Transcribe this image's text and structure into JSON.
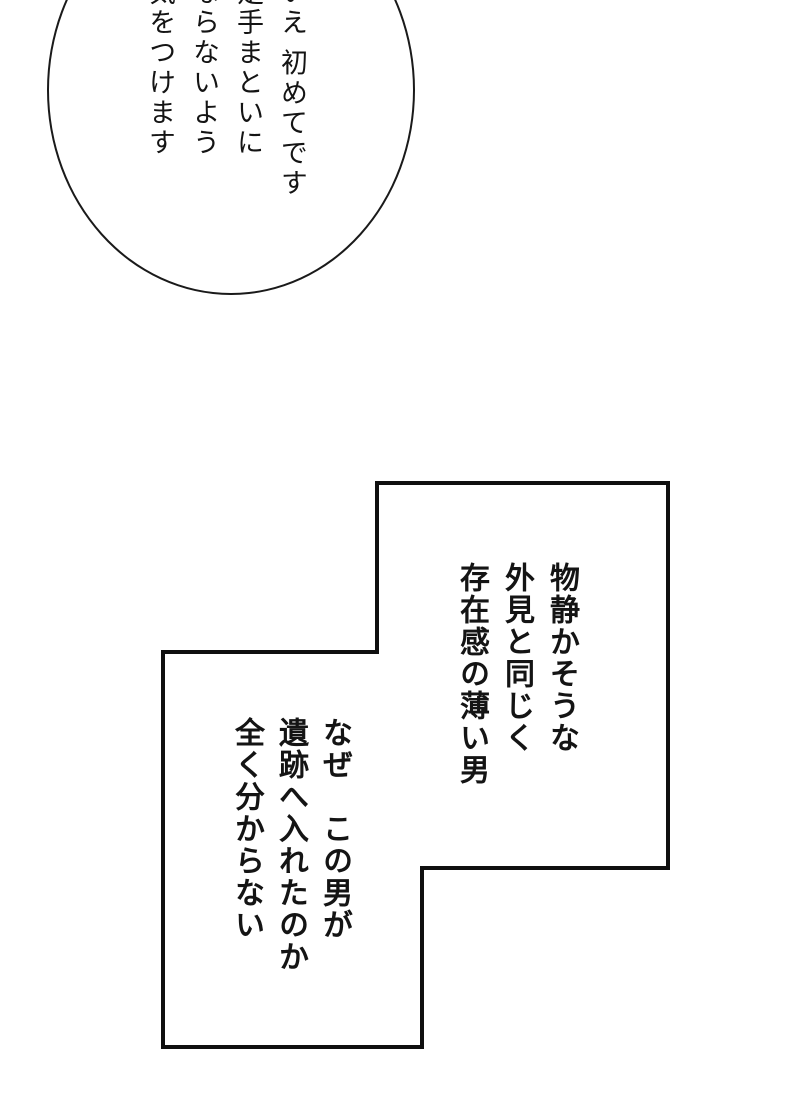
{
  "page": {
    "kind": "manga page",
    "colors": {
      "background": "#ffffff",
      "line_art": "#1a1a1a",
      "text": "#141414"
    }
  },
  "speech_bubble": {
    "lines": [
      "いえ 初めてです",
      "足手まといに",
      "ならないよう",
      "気をつけます"
    ]
  },
  "panel": {
    "narration_top": {
      "lines": [
        "物静かそうな",
        "外見と同じく",
        "存在感の薄い男"
      ]
    },
    "narration_bottom": {
      "lines": [
        "なぜ　この男が",
        "遺跡へ入れたのか",
        "全く分からない"
      ]
    }
  }
}
